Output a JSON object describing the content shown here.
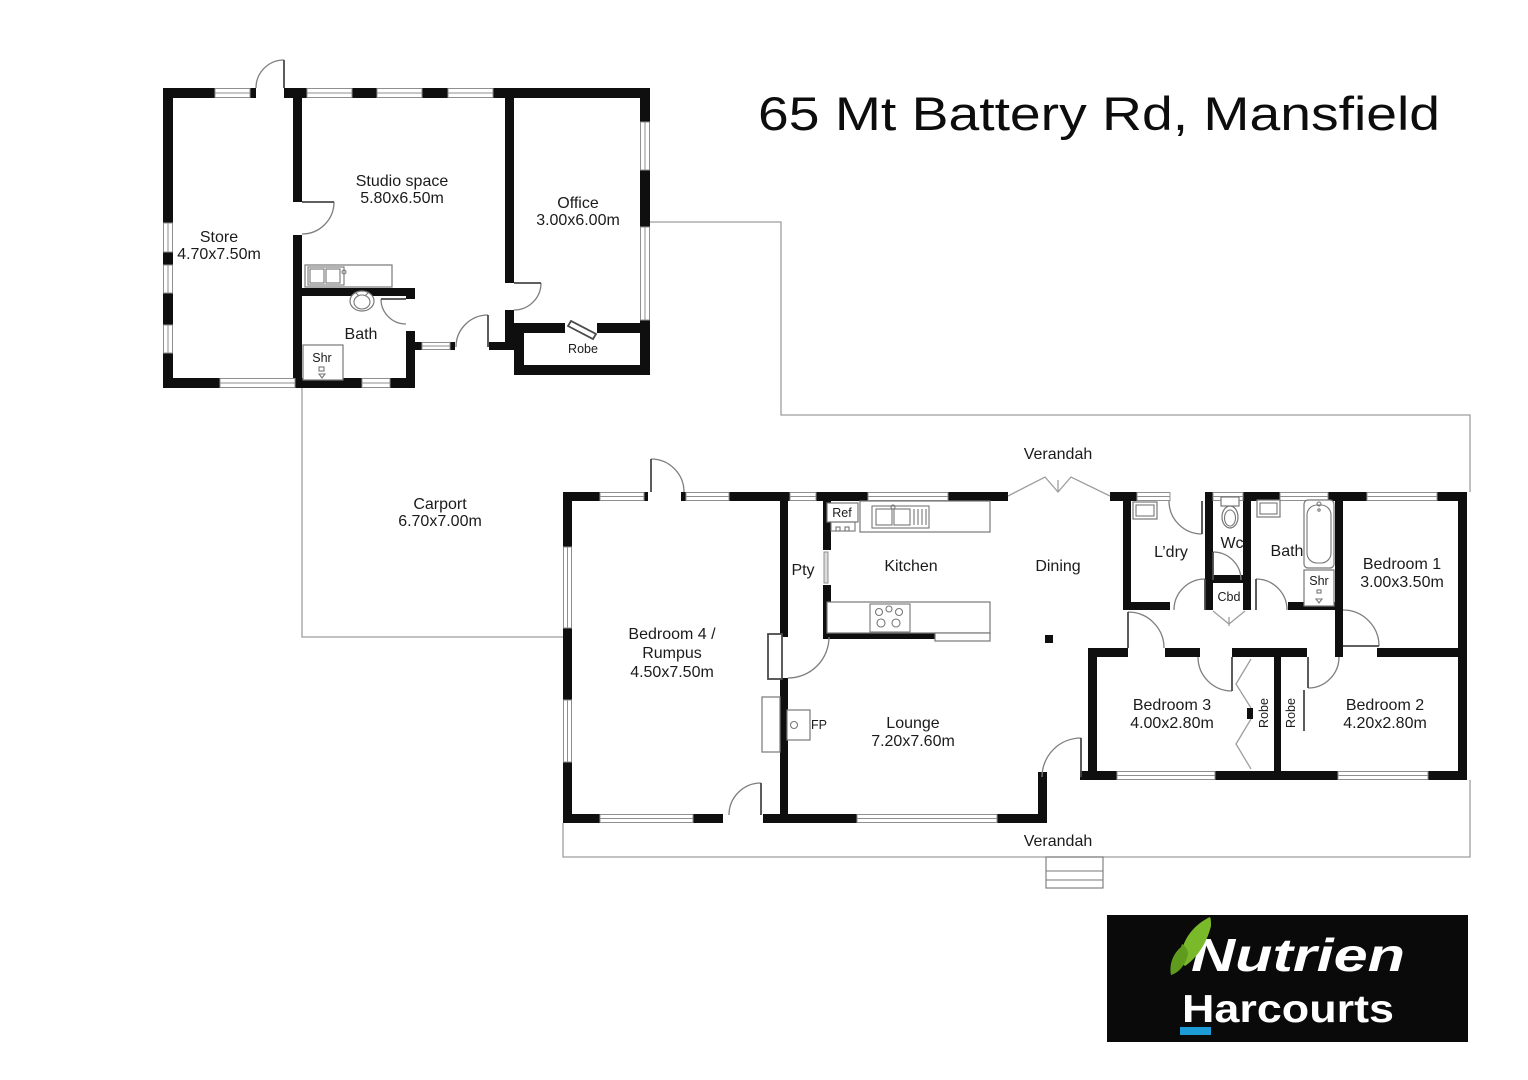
{
  "title": "65 Mt Battery Rd, Mansfield",
  "outbuilding": {
    "store": {
      "name": "Store",
      "dims": "4.70x7.50m"
    },
    "studio": {
      "name": "Studio space",
      "dims": "5.80x6.50m"
    },
    "office": {
      "name": "Office",
      "dims": "3.00x6.00m"
    },
    "bath": {
      "name": "Bath"
    },
    "shower": {
      "name": "Shr"
    },
    "robe": {
      "name": "Robe"
    }
  },
  "carport": {
    "name": "Carport",
    "dims": "6.70x7.00m"
  },
  "house": {
    "verandah_top": "Verandah",
    "verandah_bottom": "Verandah",
    "bedroom4": {
      "line1": "Bedroom 4 /",
      "line2": "Rumpus",
      "dims": "4.50x7.50m"
    },
    "pantry": "Pty",
    "fridge": "Ref",
    "kitchen": "Kitchen",
    "dining": "Dining",
    "lounge": {
      "name": "Lounge",
      "dims": "7.20x7.60m"
    },
    "fireplace": "FP",
    "laundry": "L’dry",
    "wc": "Wc",
    "bath": "Bath",
    "shower": "Shr",
    "cupboard": "Cbd",
    "bedroom1": {
      "name": "Bedroom 1",
      "dims": "3.00x3.50m"
    },
    "bedroom2": {
      "name": "Bedroom 2",
      "dims": "4.20x2.80m"
    },
    "bedroom3": {
      "name": "Bedroom 3",
      "dims": "4.00x2.80m"
    },
    "robe_left": "Robe",
    "robe_right": "Robe"
  },
  "logo": {
    "brand": "Nutrien",
    "sub_brand": "Harcourts"
  },
  "colors": {
    "wall": "#0f0f0f",
    "outline": "#9e9e9e",
    "logo_bg": "#0a0a0a",
    "leaf_green": "#7ab929",
    "leaf_green_dark": "#5f9c1d",
    "underline_blue": "#1d9bd7"
  }
}
